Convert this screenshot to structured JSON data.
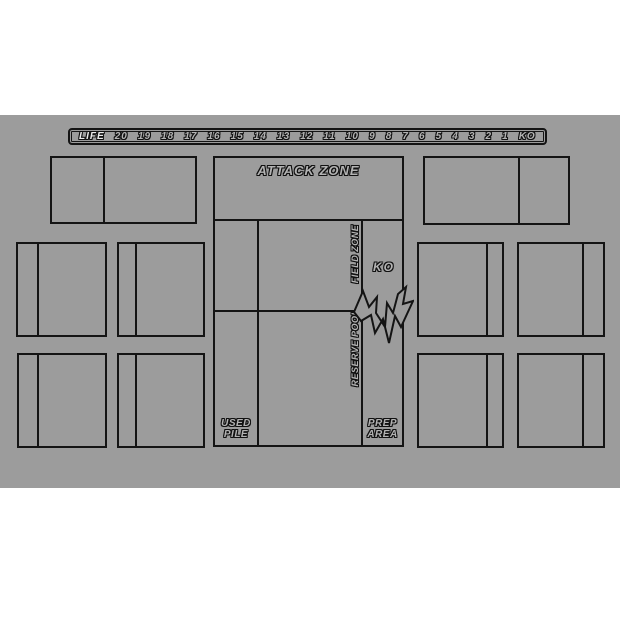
{
  "colors": {
    "mat_background": "#9c9c9c",
    "line": "#141414",
    "page_background": "#ffffff",
    "text_fill": "#b3b3b3"
  },
  "life_track": {
    "label": "LIFE",
    "values": [
      "20",
      "19",
      "18",
      "17",
      "16",
      "15",
      "14",
      "13",
      "12",
      "11",
      "10",
      "9",
      "8",
      "7",
      "6",
      "5",
      "4",
      "3",
      "2",
      "1",
      "KO"
    ]
  },
  "zones": {
    "attack": "ATTACK ZONE",
    "field": "FIELD ZONE",
    "reserve": "RESERVE POOL",
    "ko": "KO",
    "used_line1": "USED",
    "used_line2": "PILE",
    "prep_line1": "PREP",
    "prep_line2": "AREA"
  }
}
